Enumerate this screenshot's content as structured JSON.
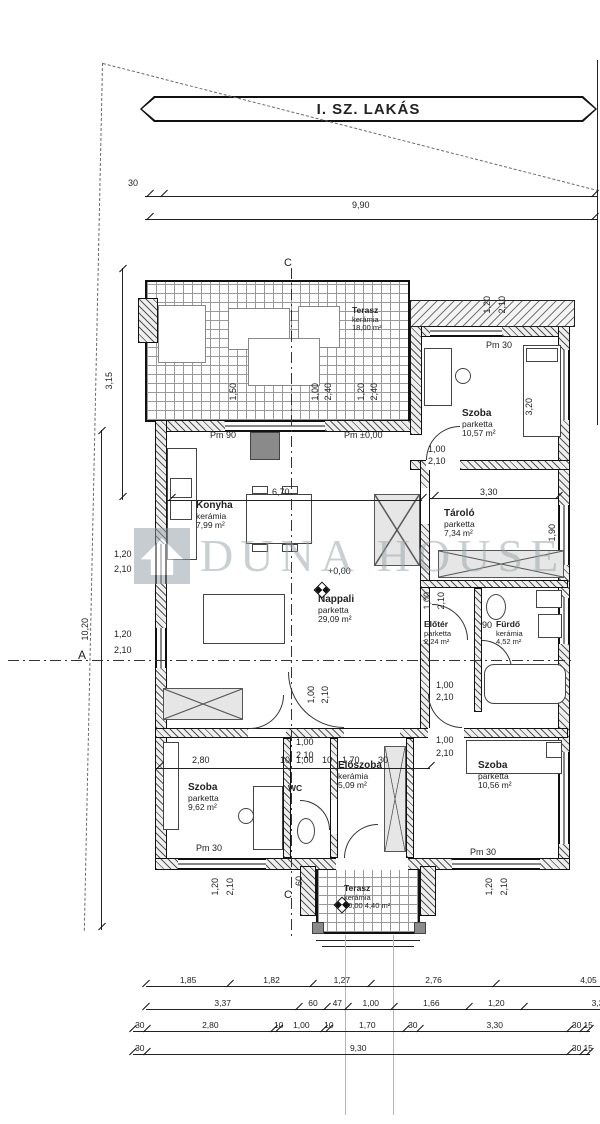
{
  "title": "I. SZ. LAKÁS",
  "watermark": "DUNA HOUSE",
  "rooms": [
    {
      "id": "terasz-top",
      "name": "Terasz",
      "floor": "kerámia",
      "area": "18,00 m²"
    },
    {
      "id": "szoba-tr",
      "name": "Szoba",
      "floor": "parketta",
      "area": "10,57 m²"
    },
    {
      "id": "konyha",
      "name": "Konyha",
      "floor": "kerámia",
      "area": "7,99 m²"
    },
    {
      "id": "tarolo",
      "name": "Tároló",
      "floor": "parketta",
      "area": "7,34 m²"
    },
    {
      "id": "nappali",
      "name": "Nappali",
      "floor": "parketta",
      "area": "29,09 m²"
    },
    {
      "id": "eloter",
      "name": "Előtér",
      "floor": "parketta",
      "area": "2,24 m²"
    },
    {
      "id": "furdo",
      "name": "Fürdő",
      "floor": "kerámia",
      "area": "4,52 m²"
    },
    {
      "id": "szoba-bl",
      "name": "Szoba",
      "floor": "parketta",
      "area": "9,62 m²"
    },
    {
      "id": "wc",
      "name": "WC",
      "floor": "",
      "area": ""
    },
    {
      "id": "eloszoba",
      "name": "Előszoba",
      "floor": "kerámia",
      "area": "5,09 m²"
    },
    {
      "id": "szoba-br",
      "name": "Szoba",
      "floor": "parketta",
      "area": "10,56 m²"
    },
    {
      "id": "terasz-bottom",
      "name": "Terasz",
      "floor": "kerámia",
      "area": "4,40 m²",
      "level": "±0,00"
    }
  ],
  "annotations": [
    {
      "id": "offset-top",
      "text": "30"
    },
    {
      "id": "width-top",
      "text": "9,90"
    },
    {
      "id": "height-left-upper",
      "text": "3,15"
    },
    {
      "id": "height-left-lower",
      "text": "10,20"
    },
    {
      "id": "section-a",
      "text": "A"
    },
    {
      "id": "section-c-top",
      "text": "C"
    },
    {
      "id": "section-c-bottom",
      "text": "C"
    },
    {
      "id": "parapet-szoba-tr",
      "text": "Pm 30"
    },
    {
      "id": "parapet-terasz-door",
      "text": "Pm ±0,00"
    },
    {
      "id": "parapet-konyha",
      "text": "Pm 90"
    },
    {
      "id": "level-nappali",
      "text": "+0,00"
    },
    {
      "id": "parapet-szoba-bl",
      "text": "Pm 30"
    },
    {
      "id": "parapet-szoba-br",
      "text": "Pm 30"
    },
    {
      "id": "door-furdo-width",
      "text": "90"
    },
    {
      "id": "dim-6-70",
      "text": "6,70"
    },
    {
      "id": "dim-3-30",
      "text": "3,30"
    },
    {
      "id": "win-left-1-w",
      "text": "1,20"
    },
    {
      "id": "win-left-1-h",
      "text": "2,10"
    },
    {
      "id": "win-left-2-w",
      "text": "1,20"
    },
    {
      "id": "win-left-2-h",
      "text": "2,10"
    },
    {
      "id": "win-tr-w",
      "text": "1,20"
    },
    {
      "id": "win-tr-h",
      "text": "2,10"
    },
    {
      "id": "dim-3-20",
      "text": "3,20"
    },
    {
      "id": "dim-1-90",
      "text": "1,90"
    },
    {
      "id": "door-tr-w",
      "text": "1,00"
    },
    {
      "id": "door-tr-h",
      "text": "2,10"
    },
    {
      "id": "door-eloter-w",
      "text": "1,00"
    },
    {
      "id": "door-eloter-h",
      "text": "2,10"
    },
    {
      "id": "door-nappali-w",
      "text": "1,00"
    },
    {
      "id": "door-nappali-h",
      "text": "2,10"
    },
    {
      "id": "door-furdo-w",
      "text": "1,00"
    },
    {
      "id": "door-furdo-h",
      "text": "2,10"
    },
    {
      "id": "door-szoba-br-w",
      "text": "1,00"
    },
    {
      "id": "door-szoba-br-h",
      "text": "2,10"
    },
    {
      "id": "door-szoba-bl-w",
      "text": "1,00"
    },
    {
      "id": "door-szoba-bl-h",
      "text": "2,10"
    },
    {
      "id": "chain-2-80",
      "text": "2,80"
    },
    {
      "id": "chain-10a",
      "text": "10"
    },
    {
      "id": "chain-1-00",
      "text": "1,00"
    },
    {
      "id": "chain-10b",
      "text": "10"
    },
    {
      "id": "chain-1-70",
      "text": "1,70"
    },
    {
      "id": "chain-30",
      "text": "30"
    },
    {
      "id": "dim-60",
      "text": "60"
    },
    {
      "id": "door-terasz-w",
      "text": "1,20"
    },
    {
      "id": "door-terasz-h",
      "text": "2,10"
    },
    {
      "id": "win-br-w",
      "text": "1,20"
    },
    {
      "id": "win-br-h",
      "text": "2,10"
    },
    {
      "id": "terasz-top-d1",
      "text": "1,50"
    },
    {
      "id": "terasz-top-d2a",
      "text": "1,00"
    },
    {
      "id": "terasz-top-d2b",
      "text": "2,40"
    },
    {
      "id": "terasz-top-d3a",
      "text": "1,20"
    },
    {
      "id": "terasz-top-d3b",
      "text": "2,40"
    }
  ],
  "dim_rows": [
    {
      "id": "row-1",
      "labels": [
        "1,85",
        "1,82",
        "1,27",
        "2,76",
        "4,05"
      ]
    },
    {
      "id": "row-2",
      "labels": [
        "3,37",
        "60",
        "47",
        "1,00",
        "1,66",
        "1,20",
        "3,35"
      ]
    },
    {
      "id": "row-3",
      "labels": [
        "30",
        "2,80",
        "10",
        "1,00",
        "10",
        "1,70",
        "30",
        "3,30",
        "30",
        "15"
      ]
    },
    {
      "id": "row-4",
      "labels": [
        "30",
        "9,30",
        "30",
        "15"
      ]
    }
  ]
}
